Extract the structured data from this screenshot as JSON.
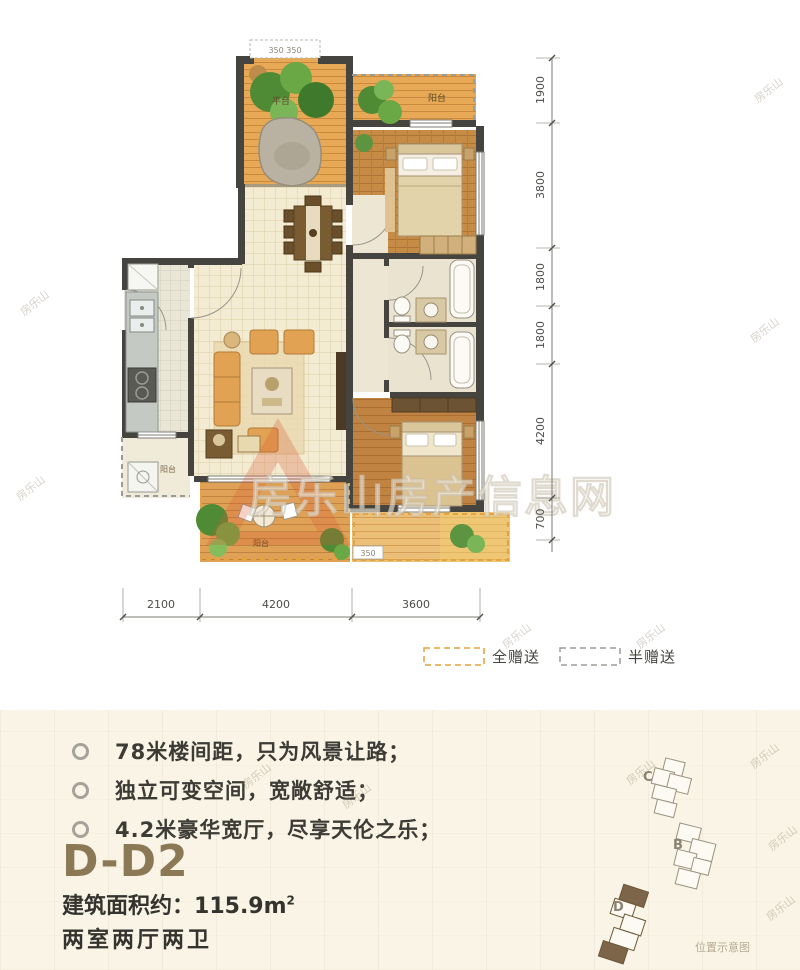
{
  "watermark": {
    "small": "房乐山",
    "big": "房乐山房产信息网"
  },
  "plan": {
    "labels": {
      "terrace_top": "平台",
      "balcony_top": "阳台",
      "balcony_left": "阳台",
      "terrace_bottom": "阳台",
      "box_top": "350 350",
      "box_bottom": "350"
    },
    "dims_right": [
      "1900",
      "3800",
      "1800",
      "1800",
      "4200",
      "700"
    ],
    "dims_bottom": [
      "2100",
      "4200",
      "3600"
    ],
    "legend": [
      {
        "label": "全赠送",
        "color": "#e6a23c"
      },
      {
        "label": "半赠送",
        "color": "#9c9c96"
      }
    ]
  },
  "features": [
    "78米楼间距，只为风景让路；",
    "独立可变空间，宽敞舒适；",
    "4.2米豪华宽厅，尽享天伦之乐；"
  ],
  "unit": {
    "name": "D-D2",
    "area_label": "建筑面积约：",
    "area_value": "115.9m",
    "area_sup": "2",
    "rooms": "两室两厅两卫"
  },
  "siteplan": {
    "buildings": [
      "C",
      "B",
      "D"
    ],
    "caption": "位置示意图"
  },
  "colors": {
    "gift_full": "#e6a23c",
    "gift_half": "#9c9c96",
    "title_brown": "#8b7956"
  }
}
